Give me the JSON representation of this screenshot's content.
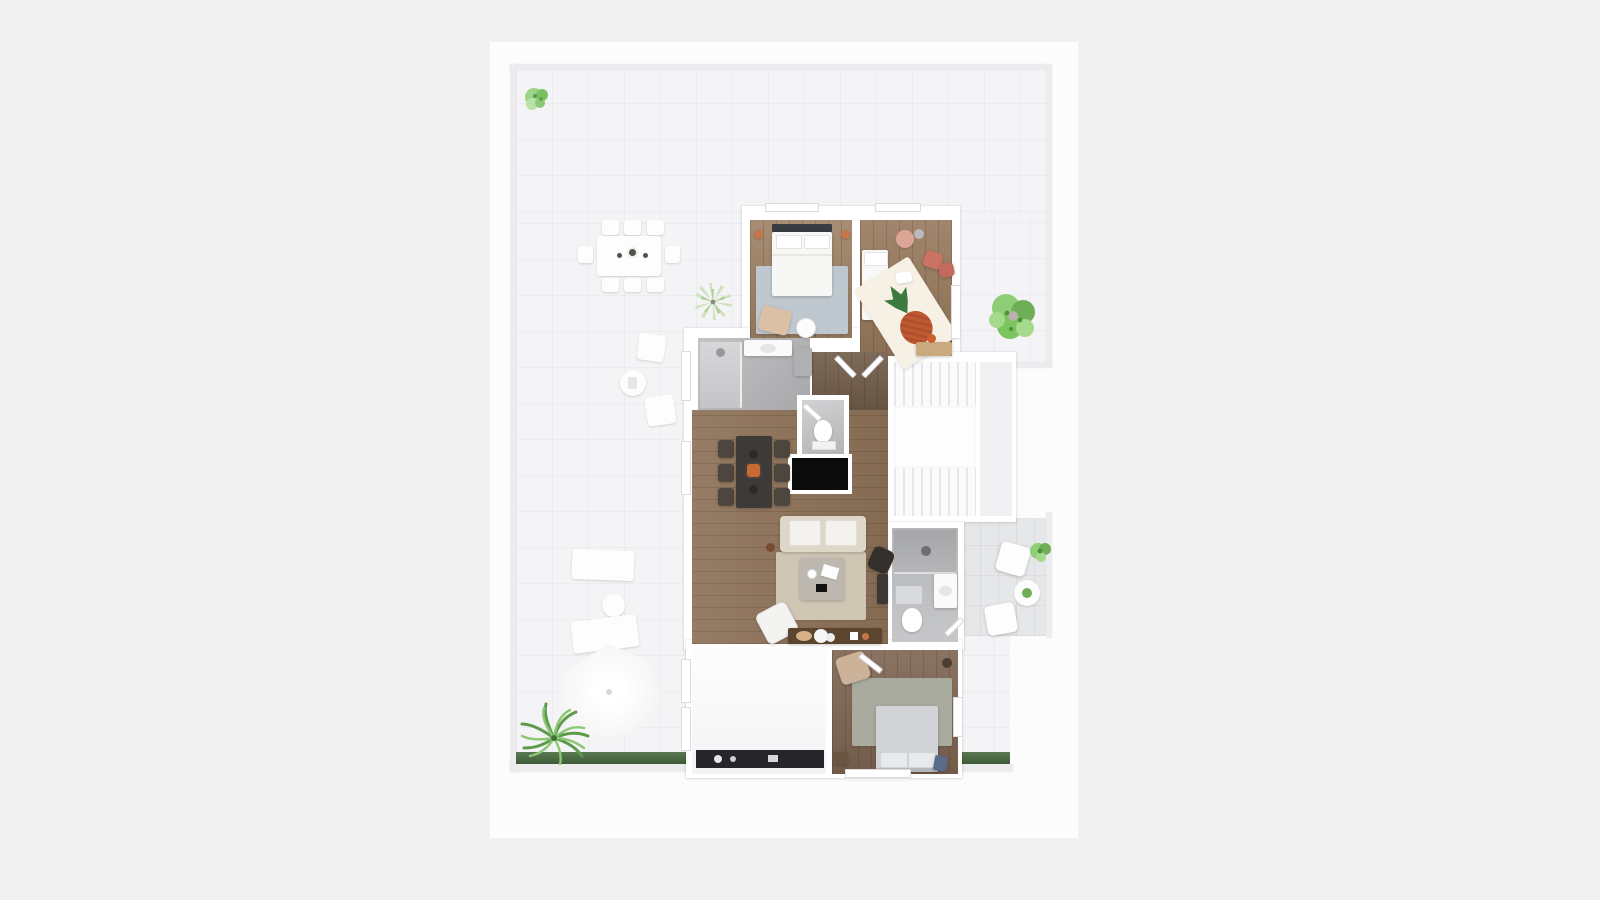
{
  "palette": {
    "canvas_bg": "#f1f1f2",
    "sheet_bg": "#fcfcfd",
    "terrace_floor": "#f4f4f6",
    "balcony_floor": "#e6e7e9",
    "wall": "#ffffff",
    "wood_light": "#9c8063",
    "wood_mid": "#8d7157",
    "wood_hall": "#77604b",
    "wood_bedroom2": "#7c6350",
    "bath_floor": "#b6b7b9",
    "wc_floor": "#c9c9cb",
    "rug_bedroom1": "#bfc8cf",
    "rug_kids": "#f7f0e5",
    "rug_living": "#d0c6b4",
    "rug_bedroom2": "#a9ab9f",
    "sofa": "#ded6c7",
    "bed_white": "#f7f7f5",
    "bed_gray": "#d2d3d6",
    "dining_table_dark": "#3e3a37",
    "console_wood": "#5c452f",
    "black_unit": "#0b0b0c",
    "accent_coral": "#cd7364",
    "accent_pineapple": "#bf5a33",
    "accent_copper": "#c4764a",
    "plant_green": "#7cc45e",
    "plant_pale": "#cfe2bd",
    "grass": "#4e7045",
    "tan_leather": "#dcc0a6"
  },
  "scene": {
    "type": "3d-floor-plan-render",
    "style": "top-down dollhouse view, no labels or dimensions visible",
    "rooms": [
      {
        "id": "terrace",
        "label": "wrap-around terrace",
        "floor": "light tile"
      },
      {
        "id": "bedroom-1",
        "label": "master bedroom (top)",
        "floor": "light wood"
      },
      {
        "id": "kids-room",
        "label": "kids room (top right)",
        "floor": "light wood"
      },
      {
        "id": "bathroom",
        "label": "main bathroom",
        "floor": "gray stone"
      },
      {
        "id": "wc",
        "label": "guest wc",
        "floor": "gray stone"
      },
      {
        "id": "living-dining",
        "label": "living and dining room",
        "floor": "mid wood"
      },
      {
        "id": "hallway",
        "label": "hallway",
        "floor": "dark wood"
      },
      {
        "id": "staircase",
        "label": "staircase with landing",
        "floor": "white"
      },
      {
        "id": "ensuite-bathroom",
        "label": "ensuite shower bathroom",
        "floor": "gray stone"
      },
      {
        "id": "balcony",
        "label": "side balcony",
        "floor": "gray tile"
      },
      {
        "id": "bedroom-2",
        "label": "bedroom (bottom)",
        "floor": "dark wood"
      },
      {
        "id": "utility-room",
        "label": "empty white room (bottom left)",
        "floor": "white"
      }
    ],
    "furniture": {
      "terrace": [
        "outdoor dining table with 8 chairs and 3 bowls",
        "spiky yucca plant",
        "2 square lounge chairs with round side table",
        "2 sun loungers",
        "round side table",
        "large patio umbrella",
        "fan palm plant",
        "small bush (top-left corner)",
        "large green plant (right side)",
        "grass strip along bottom wall"
      ],
      "bedroom-1": [
        "double bed with dark headboard and 2 pillows",
        "blue-gray rug",
        "2 copper wall lamps",
        "tan lounge chair",
        "round side table"
      ],
      "kids-room": [
        "white single bed",
        "2 coral poufs",
        "pink round table",
        "white rug with pineapple print",
        "desk with orange chair"
      ],
      "bathroom": [
        "walk-in shower",
        "vanity with sink",
        "gray cabinet"
      ],
      "wc": [
        "toilet",
        "door"
      ],
      "living-dining": [
        "dark dining table with 6 chairs and orange centerpiece",
        "beige sofa with 2 white cushions",
        "beige rug",
        "square coffee table with decor",
        "white armchair",
        "dark wood tv console with round decor",
        "black fireplace unit",
        "dark desk chair and desk"
      ],
      "staircase": [
        "upper flight",
        "landing",
        "lower flight"
      ],
      "ensuite-bathroom": [
        "shower with drain",
        "vanity with sink",
        "toilet"
      ],
      "balcony": [
        "2 white armchairs",
        "round table with plant",
        "green potted plant"
      ],
      "bedroom-2": [
        "double bed with gray linens and 2 pillows",
        "sage-gray rug",
        "tan armchair",
        "nightstand",
        "blue stool"
      ],
      "utility-room": [
        "dark glazed band with small objects"
      ]
    }
  }
}
